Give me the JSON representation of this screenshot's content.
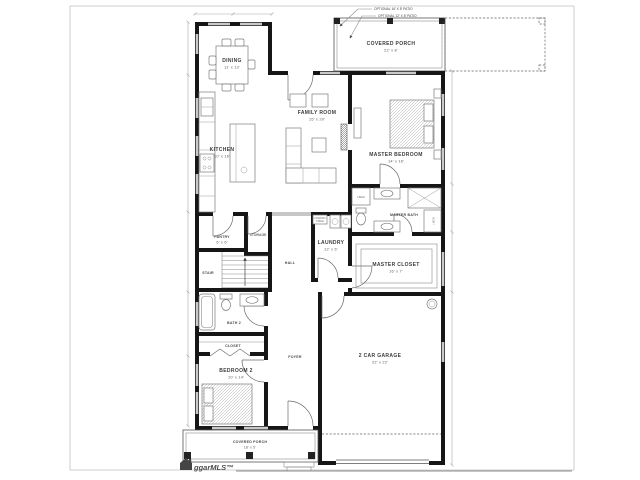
{
  "watermark": {
    "brand": "ggarMLS™"
  },
  "annotations": {
    "optional_patio_1": "OPTIONAL 16' X 8' PATIO",
    "optional_patio_2": "OPTIONAL 12' X 8' PATIO",
    "folding_table_1": "FOLDING",
    "folding_table_2": "TABLE"
  },
  "rooms": {
    "dining": {
      "name": "DINING",
      "dims": "11' x 13'"
    },
    "covered_porch_top": {
      "name": "COVERED PORCH",
      "dims": "22' x 8'"
    },
    "family_room": {
      "name": "FAMILY ROOM",
      "dims": "15' x 20'"
    },
    "kitchen": {
      "name": "KITCHEN",
      "dims": "10' x 16'"
    },
    "master_bedroom": {
      "name": "MASTER BEDROOM",
      "dims": "14' x 16'"
    },
    "master_bath": {
      "name": "MASTER BATH"
    },
    "linen_a": {
      "name": "LINEN"
    },
    "linen_b": {
      "name": "LINEN"
    },
    "master_closet": {
      "name": "MASTER CLOSET",
      "dims": "16' x 7'"
    },
    "laundry": {
      "name": "LAUNDRY",
      "dims": "12' x 6'"
    },
    "pantry": {
      "name": "PANTRY",
      "dims": "6' x 6'"
    },
    "storage": {
      "name": "STORAGE"
    },
    "stair": {
      "name": "STAIR"
    },
    "hall": {
      "name": "HALL"
    },
    "bath_2": {
      "name": "BATH 2"
    },
    "closet_2": {
      "name": "CLOSET"
    },
    "bedroom_2": {
      "name": "BEDROOM 2",
      "dims": "10' x 14'"
    },
    "foyer": {
      "name": "FOYER"
    },
    "garage": {
      "name": "2 CAR GARAGE",
      "dims": "22' x 22'"
    },
    "covered_porch_bottom": {
      "name": "COVERED PORCH",
      "dims": "18' x 5'"
    }
  }
}
